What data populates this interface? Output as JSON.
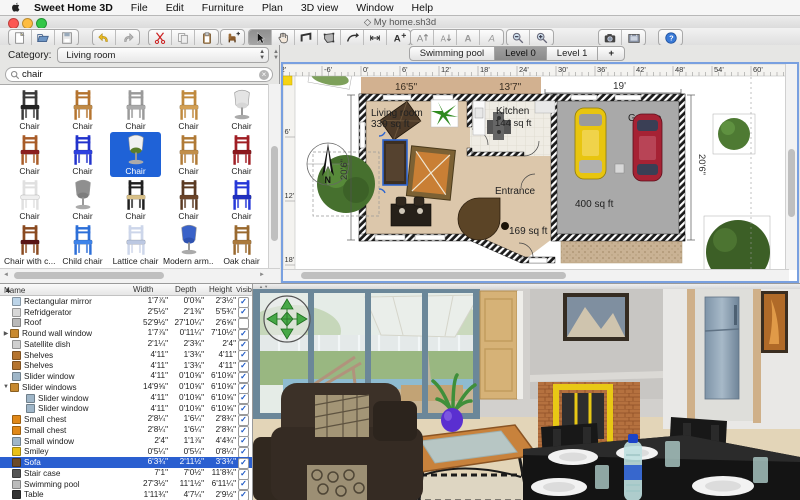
{
  "menu_bar": {
    "items": [
      "Sweet Home 3D",
      "File",
      "Edit",
      "Furniture",
      "Plan",
      "3D view",
      "Window",
      "Help"
    ]
  },
  "window": {
    "title": "◇ My home.sh3d"
  },
  "toolbar": {
    "groups": [
      {
        "buttons": [
          {
            "icon": "new-document",
            "label": "New"
          },
          {
            "icon": "open-document",
            "label": "Open"
          },
          {
            "icon": "save-document",
            "label": "Save"
          }
        ]
      },
      {
        "buttons": [
          {
            "icon": "undo",
            "label": "Undo"
          },
          {
            "icon": "redo",
            "label": "Redo"
          }
        ]
      },
      {
        "buttons": [
          {
            "icon": "cut",
            "label": "Cut"
          },
          {
            "icon": "copy",
            "label": "Copy"
          },
          {
            "icon": "paste",
            "label": "Paste"
          }
        ]
      },
      {
        "buttons": [
          {
            "icon": "add-furniture",
            "label": "Add furniture"
          }
        ]
      },
      {
        "buttons": [
          {
            "icon": "select",
            "label": "Select",
            "pressed": true
          },
          {
            "icon": "pan",
            "label": "Pan"
          },
          {
            "icon": "create-walls",
            "label": "Create walls"
          },
          {
            "icon": "create-rooms",
            "label": "Create rooms"
          },
          {
            "icon": "create-polylines",
            "label": "Create polylines"
          },
          {
            "icon": "create-dimensions",
            "label": "Create dimensions"
          },
          {
            "icon": "add-text",
            "label": "Add texts"
          }
        ]
      },
      {
        "buttons": [
          {
            "icon": "enlarge-text",
            "label": "Enlarge text"
          },
          {
            "icon": "reduce-text",
            "label": "Reduce text"
          },
          {
            "icon": "bold-style",
            "label": "Bold"
          },
          {
            "icon": "italic-style",
            "label": "Italic"
          }
        ]
      },
      {
        "buttons": [
          {
            "icon": "zoom-out",
            "label": "Zoom out"
          },
          {
            "icon": "zoom-in",
            "label": "Zoom in"
          }
        ]
      },
      {
        "buttons": [
          {
            "icon": "create-photo",
            "label": "Create photo"
          },
          {
            "icon": "create-video",
            "label": "Create video"
          }
        ]
      },
      {
        "buttons": [
          {
            "icon": "about-help",
            "label": "About"
          }
        ]
      }
    ]
  },
  "catalog": {
    "category_label": "Category:",
    "category_value": "Living room",
    "search_value": "chair",
    "items": [
      {
        "label": "Chair",
        "type": "side",
        "frame": "#3a3a3a",
        "seat": "#232323"
      },
      {
        "label": "Chair",
        "type": "side",
        "frame": "#b5742f",
        "seat": "#c08a46"
      },
      {
        "label": "Chair",
        "type": "side",
        "frame": "#9a9a9a",
        "seat": "#ababab"
      },
      {
        "label": "Chair",
        "type": "side",
        "frame": "#c08a3e",
        "seat": "#d3a055"
      },
      {
        "label": "Chair",
        "type": "swivel",
        "frame": "#e4e4e4",
        "seat": "#d6d6d6"
      },
      {
        "label": "Chair",
        "type": "side",
        "frame": "#a85c28",
        "seat": "#8c1f1f"
      },
      {
        "label": "Chair",
        "type": "side",
        "frame": "#2233cc",
        "seat": "#2d41e0"
      },
      {
        "label": "Chair",
        "type": "swivel",
        "frame": "#f2f2f2",
        "seat": "#5a7d2a",
        "selected": true
      },
      {
        "label": "Chair",
        "type": "side",
        "frame": "#b07a36",
        "seat": "#c28f4b"
      },
      {
        "label": "Chair",
        "type": "side",
        "frame": "#a01f25",
        "seat": "#8c181d"
      },
      {
        "label": "Chair",
        "type": "side",
        "frame": "#e0e0e0",
        "seat": "#efefef"
      },
      {
        "label": "Chair",
        "type": "swivel",
        "frame": "#8f8f8f",
        "seat": "#7d7d7d"
      },
      {
        "label": "Chair",
        "type": "side",
        "frame": "#1f1f1f",
        "seat": "#d8c089"
      },
      {
        "label": "Chair",
        "type": "side",
        "frame": "#5b3a22",
        "seat": "#6b4429"
      },
      {
        "label": "Chair",
        "type": "side",
        "frame": "#2638d8",
        "seat": "#2030c0"
      },
      {
        "label": "Chair with c...",
        "type": "side",
        "frame": "#8a4a20",
        "seat": "#5a1515"
      },
      {
        "label": "Child chair",
        "type": "side",
        "frame": "#2d6fd8",
        "seat": "#3d83ea"
      },
      {
        "label": "Lattice chair",
        "type": "side",
        "frame": "#cdd6ea",
        "seat": "#bcc8e2"
      },
      {
        "label": "Modern arm...",
        "type": "swivel",
        "frame": "#3a62c8",
        "seat": "#2e52b0"
      },
      {
        "label": "Oak chair",
        "type": "side",
        "frame": "#9a6a30",
        "seat": "#ab7a3d"
      },
      {
        "label": "",
        "type": "cushion",
        "frame": "#7a5a30",
        "seat": "#7a5a30"
      },
      {
        "label": "",
        "type": "cushion",
        "frame": "#3a2418",
        "seat": "#3a2418"
      },
      {
        "label": "",
        "type": "cushion",
        "frame": "#c02424",
        "seat": "#c02424"
      },
      {
        "label": "",
        "type": "cushion",
        "frame": "#66a12e",
        "seat": "#66a12e"
      },
      {
        "label": "",
        "type": "cushion",
        "frame": "#8a5a20",
        "seat": "#8a5a20"
      }
    ]
  },
  "furniture_table": {
    "columns": [
      "Name",
      "Width",
      "Depth",
      "Height",
      "Visible"
    ],
    "rows": [
      {
        "name": "Rectangular mirror",
        "width": "1'7⅞\"",
        "depth": "0'0⅜\"",
        "height": "2'3½\"",
        "visible": true,
        "icon": "#bcd4e8",
        "level": 0
      },
      {
        "name": "Refridgerator",
        "width": "2'5½\"",
        "depth": "2'1⅜\"",
        "height": "5'5¾\"",
        "visible": true,
        "icon": "#d8d8d8",
        "level": 0
      },
      {
        "name": "Roof",
        "width": "52'9½\"",
        "depth": "27'10¼\"",
        "height": "2'6⅝\"",
        "visible": false,
        "icon": "#b9b9b9",
        "level": 0
      },
      {
        "name": "Round wall window",
        "width": "1'7⅞\"",
        "depth": "0'11¼\"",
        "height": "7'10½\"",
        "visible": true,
        "icon": "#c88a30",
        "level": 0,
        "arrow": "right"
      },
      {
        "name": "Satellite dish",
        "width": "2'1¼\"",
        "depth": "2'3¾\"",
        "height": "2'4\"",
        "visible": true,
        "icon": "#cfcfcf",
        "level": 0
      },
      {
        "name": "Shelves",
        "width": "4'11\"",
        "depth": "1'3¾\"",
        "height": "4'11\"",
        "visible": true,
        "icon": "#b5742f",
        "level": 0
      },
      {
        "name": "Shelves",
        "width": "4'11\"",
        "depth": "1'3¾\"",
        "height": "4'11\"",
        "visible": true,
        "icon": "#b5742f",
        "level": 0
      },
      {
        "name": "Slider window",
        "width": "4'11\"",
        "depth": "0'10⅝\"",
        "height": "6'10⅝\"",
        "visible": true,
        "icon": "#9fb6c8",
        "level": 0
      },
      {
        "name": "Slider windows",
        "width": "14'9⅝\"",
        "depth": "0'10⅝\"",
        "height": "6'10⅝\"",
        "visible": true,
        "icon": "#c88a30",
        "level": 0,
        "arrow": "down"
      },
      {
        "name": "Slider window",
        "width": "4'11\"",
        "depth": "0'10⅝\"",
        "height": "6'10⅝\"",
        "visible": true,
        "icon": "#9fb6c8",
        "level": 1
      },
      {
        "name": "Slider window",
        "width": "4'11\"",
        "depth": "0'10⅝\"",
        "height": "6'10⅝\"",
        "visible": true,
        "icon": "#9fb6c8",
        "level": 1
      },
      {
        "name": "Small chest",
        "width": "2'8¼\"",
        "depth": "1'6¼\"",
        "height": "2'8¾\"",
        "visible": true,
        "icon": "#e08818",
        "level": 0
      },
      {
        "name": "Small chest",
        "width": "2'8¼\"",
        "depth": "1'6¼\"",
        "height": "2'8¾\"",
        "visible": true,
        "icon": "#e08818",
        "level": 0
      },
      {
        "name": "Small window",
        "width": "2'4\"",
        "depth": "1'1⅞\"",
        "height": "4'4¾\"",
        "visible": true,
        "icon": "#9fb6c8",
        "level": 0
      },
      {
        "name": "Smiley",
        "width": "0'5¼\"",
        "depth": "0'5¼\"",
        "height": "0'8¼\"",
        "visible": true,
        "icon": "#e8c018",
        "level": 0
      },
      {
        "name": "Sofa",
        "width": "6'3¾\"",
        "depth": "2'11½\"",
        "height": "3'3¾\"",
        "visible": true,
        "icon": "#6a4a2a",
        "level": 0,
        "selected": true
      },
      {
        "name": "Stair case",
        "width": "7'1\"",
        "depth": "7'0½\"",
        "height": "11'8¾\"",
        "visible": true,
        "icon": "#555555",
        "level": 0
      },
      {
        "name": "Swimming pool",
        "width": "27'3½\"",
        "depth": "11'1½\"",
        "height": "6'11¼\"",
        "visible": true,
        "icon": "#bbbbbb",
        "level": 0
      },
      {
        "name": "Table",
        "width": "1'11¾\"",
        "depth": "4'7¼\"",
        "height": "2'9½\"",
        "visible": true,
        "icon": "#333333",
        "level": 0
      }
    ]
  },
  "plan": {
    "tabs": [
      {
        "label": "Swimming pool"
      },
      {
        "label": "Level 0",
        "active": true
      },
      {
        "label": "Level 1"
      },
      {
        "label": "+",
        "add": true
      }
    ],
    "ruler_h": [
      "-12'",
      "-6'",
      "0'",
      "6'",
      "12'",
      "18'",
      "24'",
      "30'",
      "36'",
      "42'",
      "48'",
      "54'",
      "60'"
    ],
    "ruler_v": [
      "6'",
      "12'",
      "18'"
    ],
    "rooms": [
      {
        "name": "Living room",
        "area": "339 sq ft"
      },
      {
        "name": "Kitchen",
        "area": "144 sq ft"
      },
      {
        "name": "Entrance",
        "area": "169 sq ft"
      },
      {
        "name": "Garage",
        "area": "400 sq ft"
      }
    ],
    "dimensions": {
      "top1": "16'5\"",
      "top2": "13'7\"",
      "top3": "19'",
      "left": "20'6\"",
      "right": "20'6\""
    },
    "compass_label": "N"
  },
  "colors": {
    "selection_blue": "#1f62d7",
    "floor_tan": "#dcc7ab",
    "garage_gray": "#a9a9a9",
    "car_yellow": "#e8c50f",
    "car_red": "#a62234",
    "check_blue": "#1a56c4"
  }
}
